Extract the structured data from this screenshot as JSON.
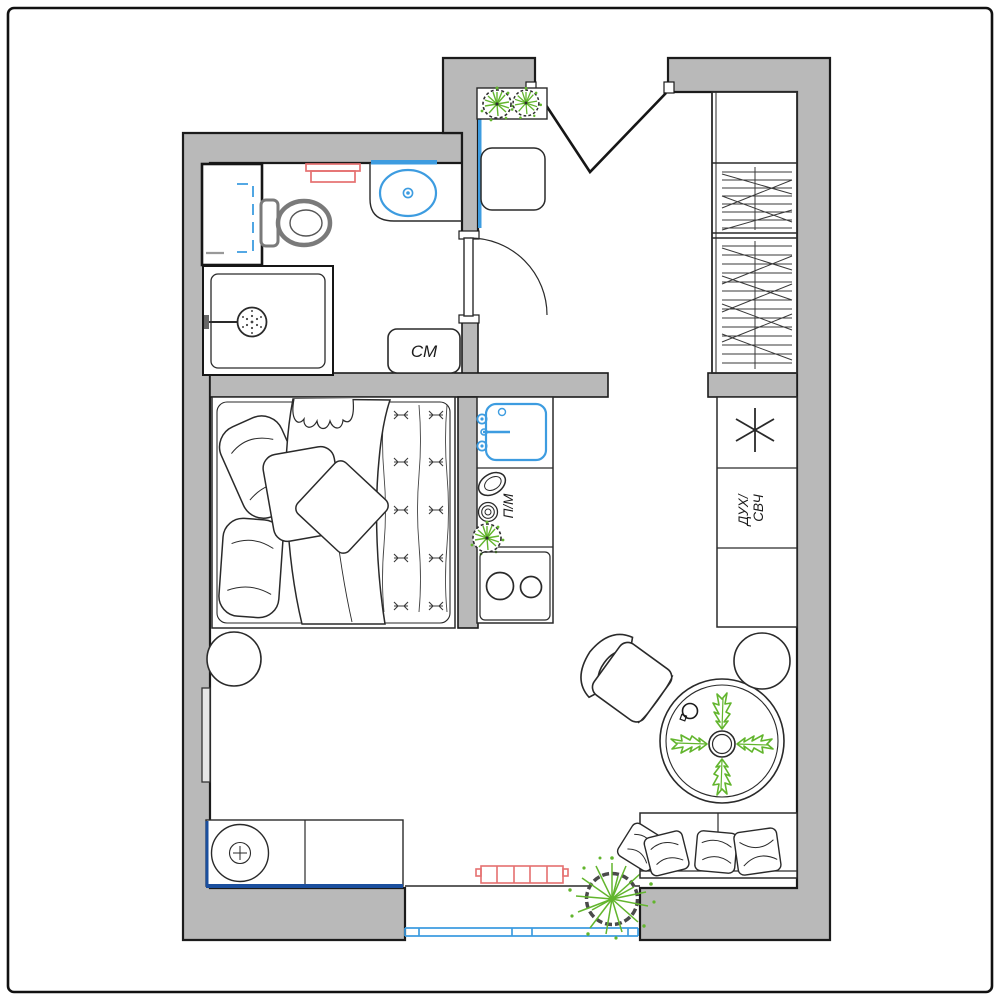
{
  "plan": {
    "title": "studio-apartment-floor-plan",
    "labels": {
      "washing_machine": "СМ",
      "dishwasher": "П/М",
      "oven_line1": "ДУХ/",
      "oven_line2": "СВЧ"
    },
    "colors": {
      "wall_fill": "#b9b9b9",
      "outline": "#1b1b1b",
      "plumbing_blue": "#3d9ce0",
      "accent_navy": "#1b4f9e",
      "radiator_red": "#e57070",
      "plant_green": "#62b52d"
    }
  }
}
